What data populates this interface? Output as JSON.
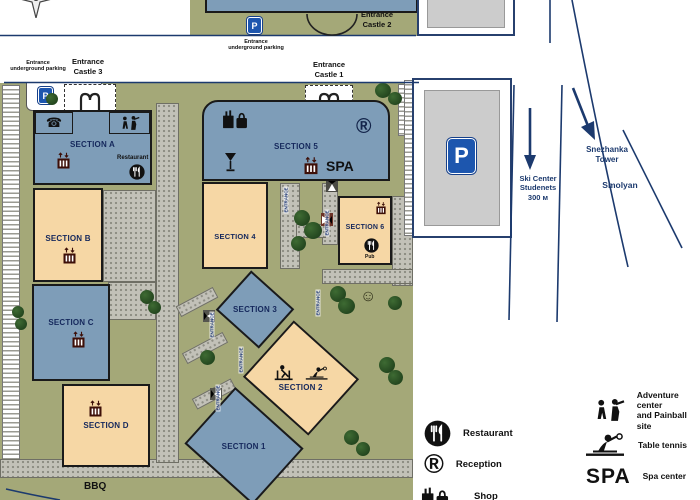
{
  "map": {
    "background_color": "#a4a878",
    "building_blue": "#7e9db8",
    "building_peach": "#f6d7a5",
    "road_line_color": "#1c3a6e",
    "entrances": {
      "castle_1": "Entrance\nCastle 1",
      "castle_2": "Entrance\nCastle 2",
      "castle_3": "Entrance\nCastle 3",
      "underground_top": "Entrance\nunderground parking",
      "underground_left": "Entrance\nunderground parking",
      "path_label": "ENTRANCE"
    },
    "sections": {
      "a": "SECTION A",
      "b": "SECTION B",
      "c": "SECTION C",
      "d": "SECTION D",
      "s1": "SECTION 1",
      "s2": "SECTION 2",
      "s3": "SECTION 3",
      "s4": "SECTION 4",
      "s5": "SECTION 5",
      "s6": "SECTION 6"
    },
    "amenities": {
      "restaurant": "Restaurant",
      "spa": "SPA",
      "pub": "Pub",
      "bbq": "BBQ"
    },
    "symbols": {
      "parking": "P",
      "reception": "®",
      "smiley": "☺",
      "phone": "☎"
    }
  },
  "roads": {
    "ski_center": "Ski Center\nStudenets\n300 м",
    "snezhanka_tower": "Snezhanka\nTower",
    "smolyan": "Smolyan"
  },
  "legend": {
    "restaurant": "Restaurant",
    "reception": "Reception",
    "shop": "Shop",
    "adventure": "Adventure center\nand Painball site",
    "table_tennis": "Table tennis",
    "spa_mark": "SPA",
    "spa_center": "Spa center"
  }
}
